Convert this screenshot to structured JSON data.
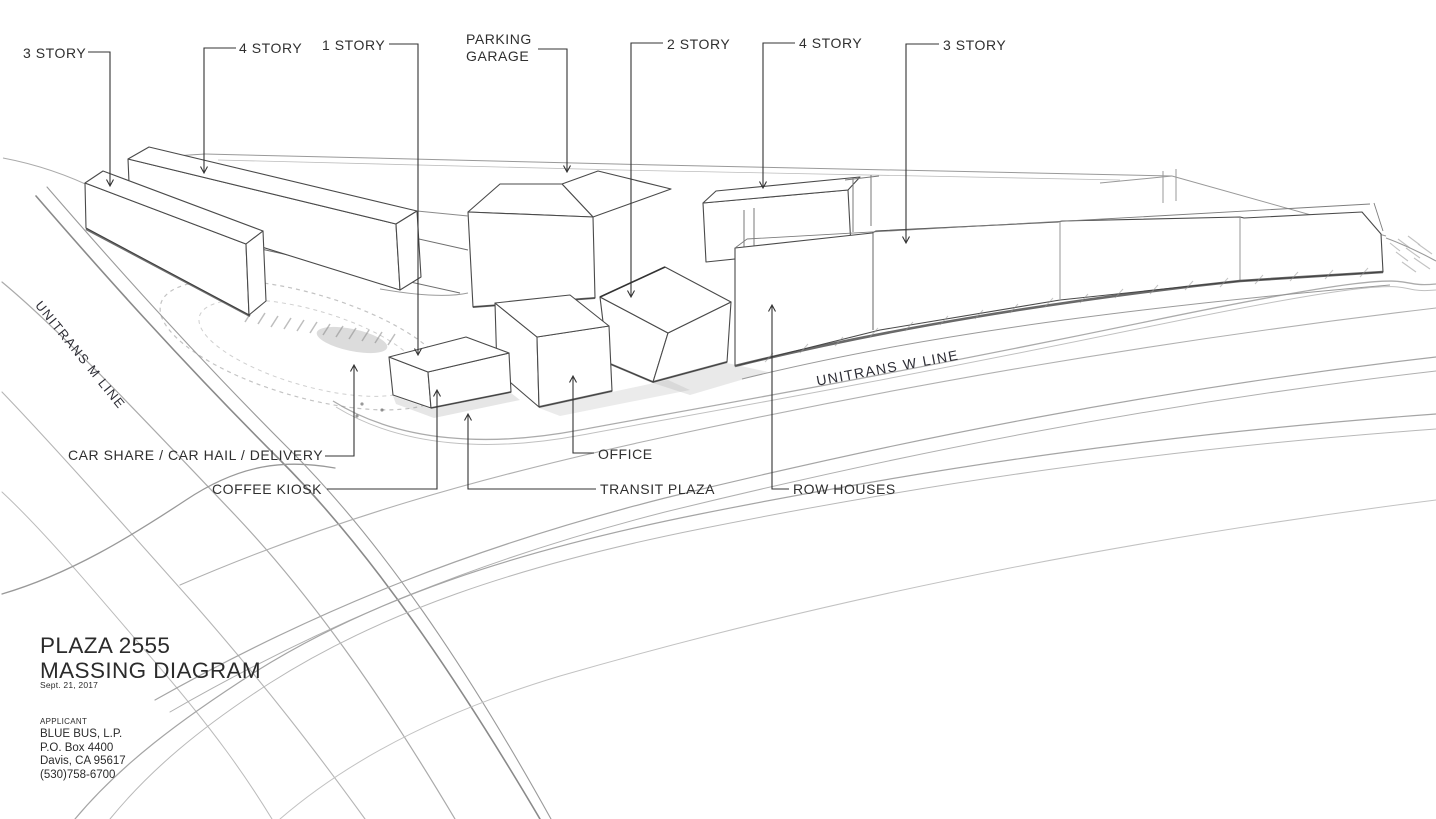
{
  "canvas": {
    "background": "#ffffff",
    "ink_color": "#2f2f2f",
    "building_line_color": "#4a4a4a",
    "street_line_color": "#a8a8a8",
    "leader_line_color": "#333333"
  },
  "story_labels": [
    {
      "text": "3 STORY"
    },
    {
      "text": "4 STORY"
    },
    {
      "text": "1 STORY"
    },
    {
      "text": "PARKING\nGARAGE"
    },
    {
      "text": "2 STORY"
    },
    {
      "text": "4 STORY"
    },
    {
      "text": "3 STORY"
    }
  ],
  "feature_labels": [
    {
      "text": "CAR SHARE / CAR HAIL / DELIVERY"
    },
    {
      "text": "COFFEE KIOSK"
    },
    {
      "text": "OFFICE"
    },
    {
      "text": "TRANSIT PLAZA"
    },
    {
      "text": "ROW HOUSES"
    }
  ],
  "street_labels": [
    {
      "text": "UNITRANS M LINE"
    },
    {
      "text": "UNITRANS W LINE"
    }
  ],
  "title_block": {
    "project": "PLAZA 2555",
    "sheet": "MASSING DIAGRAM",
    "date": "Sept. 21, 2017",
    "applicant_heading": "APPLICANT",
    "applicant": "BLUE BUS, L.P.\nP.O. Box 4400\nDavis, CA 95617\n(530)758-6700"
  }
}
